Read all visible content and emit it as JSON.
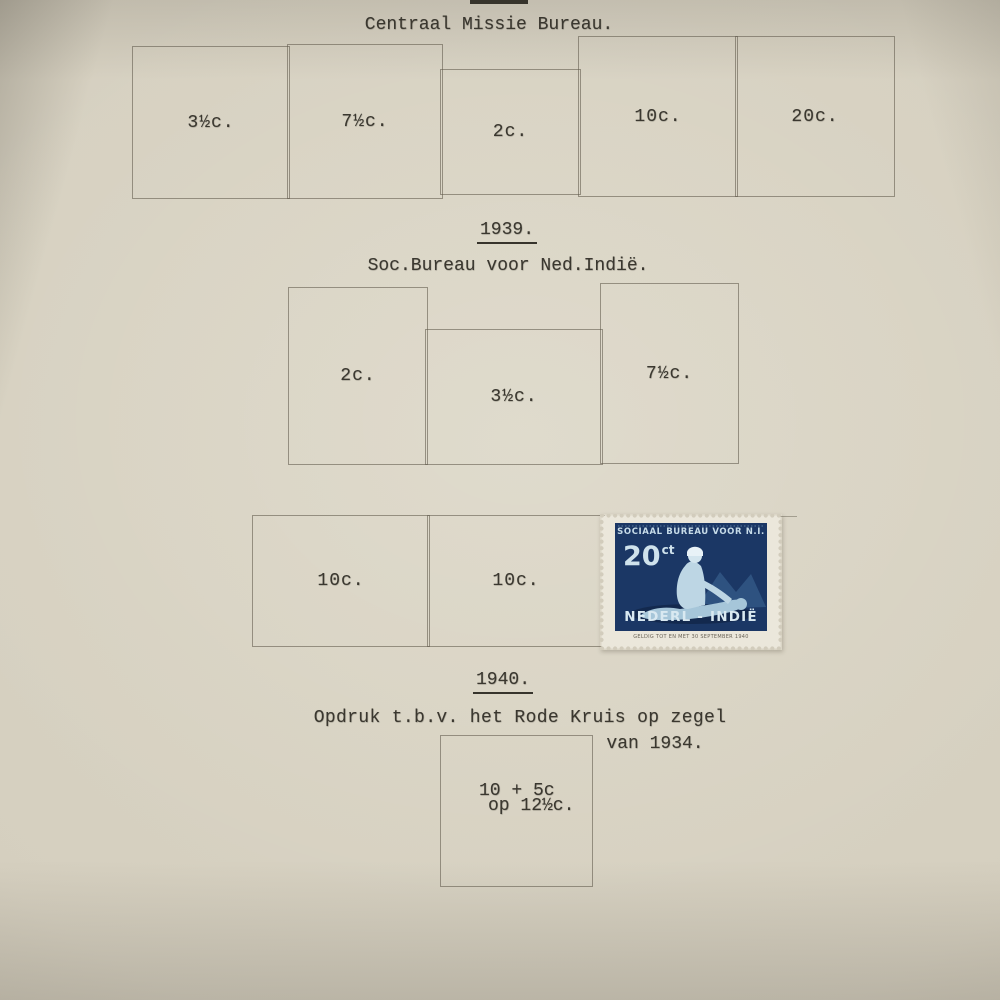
{
  "colors": {
    "paper_center": "#dcd7c7",
    "paper_edge": "#a89f8f",
    "ink": "#3a372f",
    "pencil_line": "#8b8577",
    "stamp_navy": "#1b3765",
    "stamp_light_blue": "#cfe2ec",
    "stamp_paper": "#ebe7db"
  },
  "sections": {
    "s1938": {
      "title": "Centraal Missie Bureau.",
      "placeholders": [
        "3½c.",
        "7½c.",
        "2c.",
        "10c.",
        "20c."
      ]
    },
    "s1939": {
      "year": "1939.",
      "title": "Soc.Bureau voor Ned.Indië.",
      "placeholders": [
        "2c.",
        "3½c.",
        "7½c."
      ],
      "row2_placeholders": [
        "10c.",
        "10c."
      ]
    },
    "s1940": {
      "year": "1940.",
      "note_line1": "Opdruk t.b.v. het Rode Kruis op zegel",
      "note_line2": "van 1934.",
      "surcharge_line1": "10 + 5c",
      "surcharge_line2": "op 12½c."
    }
  },
  "stamp": {
    "header": "SOCIAAL BUREAU VOOR N.I.",
    "value": "20",
    "value_unit": "ct",
    "country": "NEDERL - INDIË",
    "validity_note": "GELDIG TOT EN MET 30 SEPTEMBER 1940"
  }
}
